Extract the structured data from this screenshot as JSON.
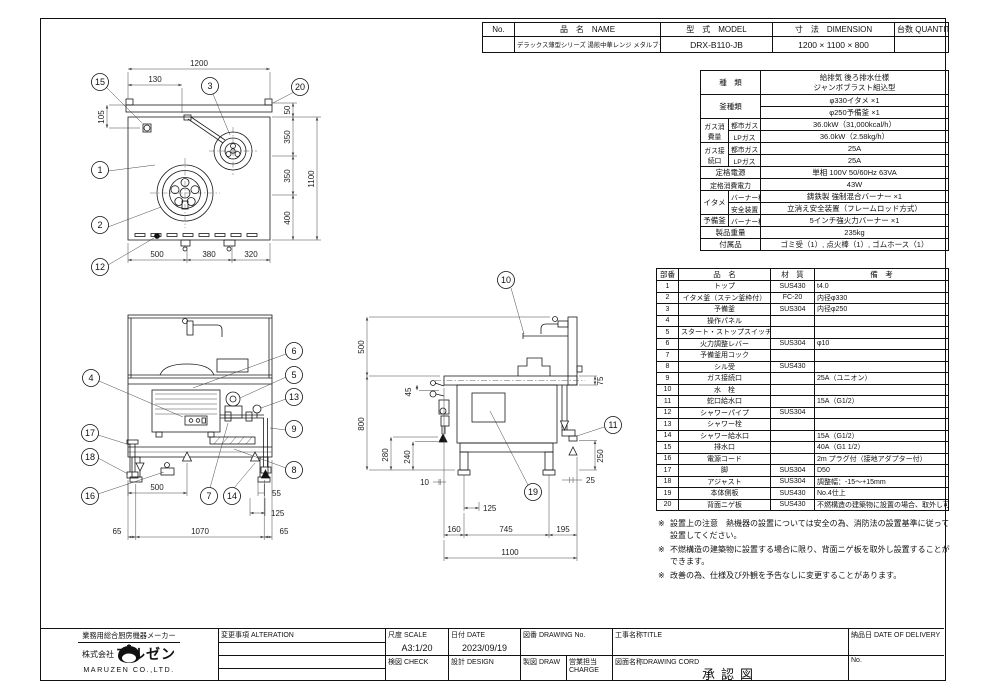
{
  "header_table": {
    "no_label": "No.",
    "name_label": "品　名　NAME",
    "model_label": "型　式　MODEL",
    "dimension_label": "寸　法　DIMENSION",
    "quantity_label": "台数 QUANTITY",
    "no_value": "",
    "name_value": "デラックス薄型シリーズ 湯煎中華レンジ メタルブラスト/ジャンボブラスト組込型",
    "model_value": "DRX-B110-JB",
    "dimension_value": "1200 × 1100 × 800",
    "quantity_value": ""
  },
  "spec_table": {
    "type_label": "種　類",
    "type_line1": "給排気 後ろ排水仕様",
    "type_line2": "ジャンボブラスト組込型",
    "kama_label": "釜種類",
    "kama_value1": "φ330イタメ ×1",
    "kama_value2": "φ250予備釜 ×1",
    "gas_consumption_label": "ガス消費量",
    "gas_connection_label": "ガス接続口",
    "city_gas_label": "都市ガス",
    "lp_gas_label": "LPガス",
    "city_gas_label2": "都市ガス",
    "lp_gas_label2": "LPガス",
    "consumption_city": "36.0kW（31,000kcal/h）",
    "consumption_lp": "36.0kW（2.58kg/h）",
    "connection_city": "25A",
    "connection_lp": "25A",
    "power_label": "定格電源",
    "power_value": "単相 100V 50/60Hz 63VA",
    "wattage_label": "定格消費電力",
    "wattage_value": "43W",
    "itame_label": "イタメ",
    "itame_burner_label": "バーナー種類",
    "itame_burner_value": "鋳鉄製 強制混合バーナー ×1",
    "safety_label": "安全装置",
    "safety_value": "立消え安全装置（フレームロッド方式）",
    "yobi_label": "予備釜",
    "yobi_burner_label": "バーナー種類",
    "yobi_burner_value": "5インチ強火力バーナー ×1",
    "weight_label": "製品重量",
    "weight_value": "235kg",
    "accessory_label": "付属品",
    "accessory_value": "ゴミ受（1）, 点火棒（1）, ゴムホース（1）"
  },
  "parts_table": {
    "headers": {
      "no": "部番",
      "name": "品　名",
      "material": "材　質",
      "note": "備　考"
    },
    "rows": [
      {
        "no": "1",
        "name": "トップ",
        "material": "SUS430",
        "note": "t4.0"
      },
      {
        "no": "2",
        "name": "イタメ釜（ステン釜枠付）",
        "material": "FC-20",
        "note": "内径φ330"
      },
      {
        "no": "3",
        "name": "予備釜",
        "material": "SUS304",
        "note": "内径φ250"
      },
      {
        "no": "4",
        "name": "操作パネル",
        "material": "",
        "note": ""
      },
      {
        "no": "5",
        "name": "スタート・ストップスイッチ",
        "material": "",
        "note": ""
      },
      {
        "no": "6",
        "name": "火力調整レバー",
        "material": "SUS304",
        "note": "φ10"
      },
      {
        "no": "7",
        "name": "予備釜用コック",
        "material": "",
        "note": ""
      },
      {
        "no": "8",
        "name": "シル受",
        "material": "SUS430",
        "note": ""
      },
      {
        "no": "9",
        "name": "ガス接続口",
        "material": "",
        "note": "25A（ユニオン）"
      },
      {
        "no": "10",
        "name": "水　栓",
        "material": "",
        "note": ""
      },
      {
        "no": "11",
        "name": "蛇口給水口",
        "material": "",
        "note": "15A（G1/2）"
      },
      {
        "no": "12",
        "name": "シャワーパイプ",
        "material": "SUS304",
        "note": ""
      },
      {
        "no": "13",
        "name": "シャワー栓",
        "material": "",
        "note": ""
      },
      {
        "no": "14",
        "name": "シャワー給水口",
        "material": "",
        "note": "15A（G1/2）"
      },
      {
        "no": "15",
        "name": "排水口",
        "material": "",
        "note": "40A（G1 1/2）"
      },
      {
        "no": "16",
        "name": "電源コード",
        "material": "",
        "note": "2m プラグ付（接地アダプター付）"
      },
      {
        "no": "17",
        "name": "脚",
        "material": "SUS304",
        "note": "D50"
      },
      {
        "no": "18",
        "name": "アジャスト",
        "material": "SUS304",
        "note": "調整幅：-15～+15mm"
      },
      {
        "no": "19",
        "name": "本体側板",
        "material": "SUS430",
        "note": "No.4仕上"
      },
      {
        "no": "20",
        "name": "背面ニゲ板",
        "material": "SUS430",
        "note": "不燃構造の建築物に設置の場合、取外し可"
      }
    ]
  },
  "notes": [
    {
      "marker": "※",
      "text": "設置上の注意　熱機器の設置については安全の為、消防法の設置基準に従って設置してください。"
    },
    {
      "marker": "※",
      "text": "不燃構造の建築物に設置する場合に限り、背面ニゲ板を取外し設置することができます。"
    },
    {
      "marker": "※",
      "text": "改善の為、仕様及び外観を予告なしに変更することがあります。"
    }
  ],
  "title_block": {
    "tagline": "業務用総合厨房機器メーカー",
    "company_prefix": "株式会社",
    "company": "マルゼン",
    "company_en": "MARUZEN CO.,LTD.",
    "alteration_label": "変更事項 ALTERATION",
    "scale_label": "尺度 SCALE",
    "scale_value": "A3:1/20",
    "date_label": "日付 DATE",
    "date_value": "2023/09/19",
    "check_label": "検図 CHECK",
    "design_label": "設計 DESIGN",
    "draw_label": "製図 DRAW",
    "charge_label": "営業担当CHARGE",
    "drawing_no_label": "図番 DRAWING No.",
    "title_label": "工事名称TITLE",
    "drawing_cord_label": "図面名称DRAWING CORD",
    "drawing_name_value": "承認図",
    "delivery_label": "納品日  DATE OF DELIVERY",
    "delivery_no_label": "No."
  },
  "balloons": {
    "b1": "1",
    "b2": "2",
    "b3": "3",
    "b4": "4",
    "b5": "5",
    "b6": "6",
    "b7": "7",
    "b8": "8",
    "b9": "9",
    "b10": "10",
    "b11": "11",
    "b12": "12",
    "b13": "13",
    "b14": "14",
    "b15": "15",
    "b16": "16",
    "b17": "17",
    "b18": "18",
    "b19": "19",
    "b20": "20"
  },
  "views": {
    "plan": {
      "dims": {
        "w1200": "1200",
        "d130": "130",
        "d105": "105",
        "d50": "50",
        "d350a": "350",
        "d350b": "350",
        "d400": "400",
        "d1100": "1100",
        "d500": "500",
        "d380": "380",
        "d320": "320"
      }
    },
    "front": {
      "dims": {
        "d500": "500",
        "d55": "55",
        "d125": "125",
        "d65l": "65",
        "d1070": "1070",
        "d65r": "65"
      }
    },
    "side": {
      "dims": {
        "d500": "500",
        "d800": "800",
        "d45": "45",
        "d280": "280",
        "d240": "240",
        "d75": "75",
        "d250": "250",
        "d10": "10",
        "d125": "125",
        "d25": "25",
        "d160": "160",
        "d745": "745",
        "d195": "195",
        "d1100": "1100"
      }
    }
  },
  "colors": {
    "line": "#1a1a1a",
    "dim": "#444444",
    "paper": "#ffffff"
  }
}
